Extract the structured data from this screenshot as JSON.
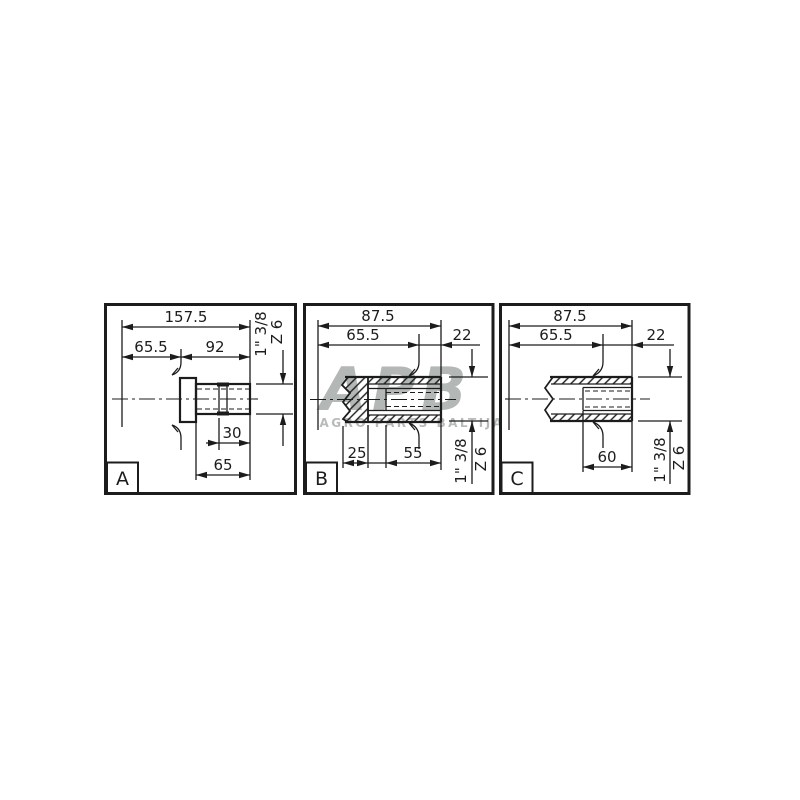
{
  "watermark": {
    "logo": "APB",
    "subtitle": "AGRO PARTS BALTIJA"
  },
  "colors": {
    "background": "#ffffff",
    "line": "#1c1c1c",
    "watermark_logo": "#b3b8b6",
    "watermark_subtitle": "#b6bbb9"
  },
  "panels": {
    "a": {
      "label": "A",
      "dim_total": "157.5",
      "dim_left": "65.5",
      "dim_right": "92",
      "dim_groove_to_end": "30",
      "dim_spline_length": "65",
      "spline_size": "1\" 3/8",
      "spline_teeth": "Z 6"
    },
    "b": {
      "label": "B",
      "dim_total": "87.5",
      "dim_left": "65.5",
      "dim_right": "22",
      "dim_bore_depth": "25",
      "dim_spline_length": "55",
      "spline_size": "1\" 3/8",
      "spline_teeth": "Z 6"
    },
    "c": {
      "label": "C",
      "dim_total": "87.5",
      "dim_left": "65.5",
      "dim_right": "22",
      "dim_spline_length": "60",
      "spline_size": "1\" 3/8",
      "spline_teeth": "Z 6"
    }
  }
}
